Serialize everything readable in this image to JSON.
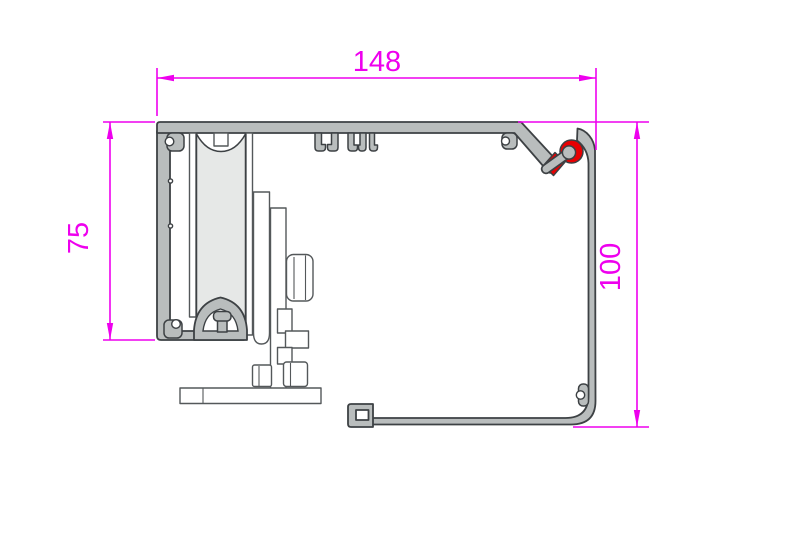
{
  "drawing": {
    "kind": "sliding-track profile cross-section"
  },
  "dimensions": {
    "overall_width": "148",
    "left_height": "75",
    "right_height": "100"
  },
  "colors": {
    "dimension": "#ee00ee",
    "profile_fill": "#b9bdbd",
    "profile_outline": "#3d4144",
    "roller_fill": "#e6e8e7",
    "hardware_outline": "#54585a",
    "gasket_red": "#e80002",
    "background": "#ffffff"
  }
}
